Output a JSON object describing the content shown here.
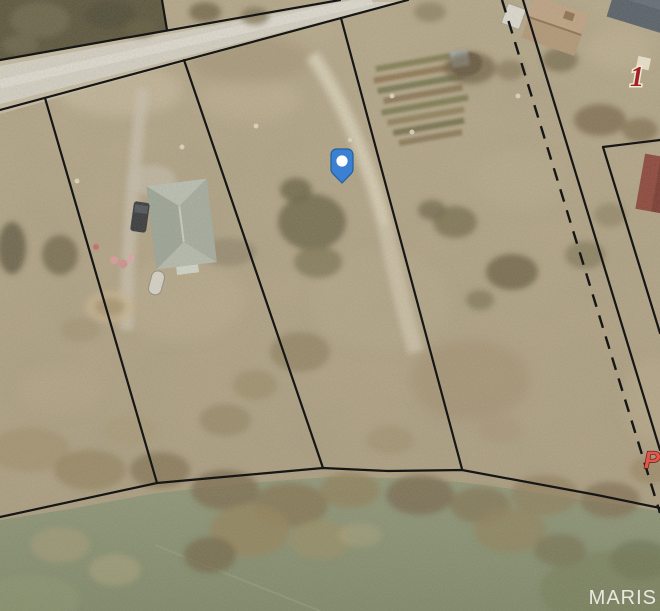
{
  "map": {
    "watermark": "MARIS",
    "pin": {
      "fill": "#3b80d1",
      "border": "#23609f",
      "dot": "#ffffff"
    },
    "labels": {
      "lot_number": {
        "text": "1",
        "color": "#a32028"
      },
      "road_letter": {
        "text": "P",
        "color": "#e2574d"
      }
    },
    "palette": {
      "ground": "#b2a385",
      "water": "#87906f",
      "road_pavement": "#d3cfc3",
      "boundary_line": "#161616",
      "house_roof": "#a9b1a4"
    }
  }
}
